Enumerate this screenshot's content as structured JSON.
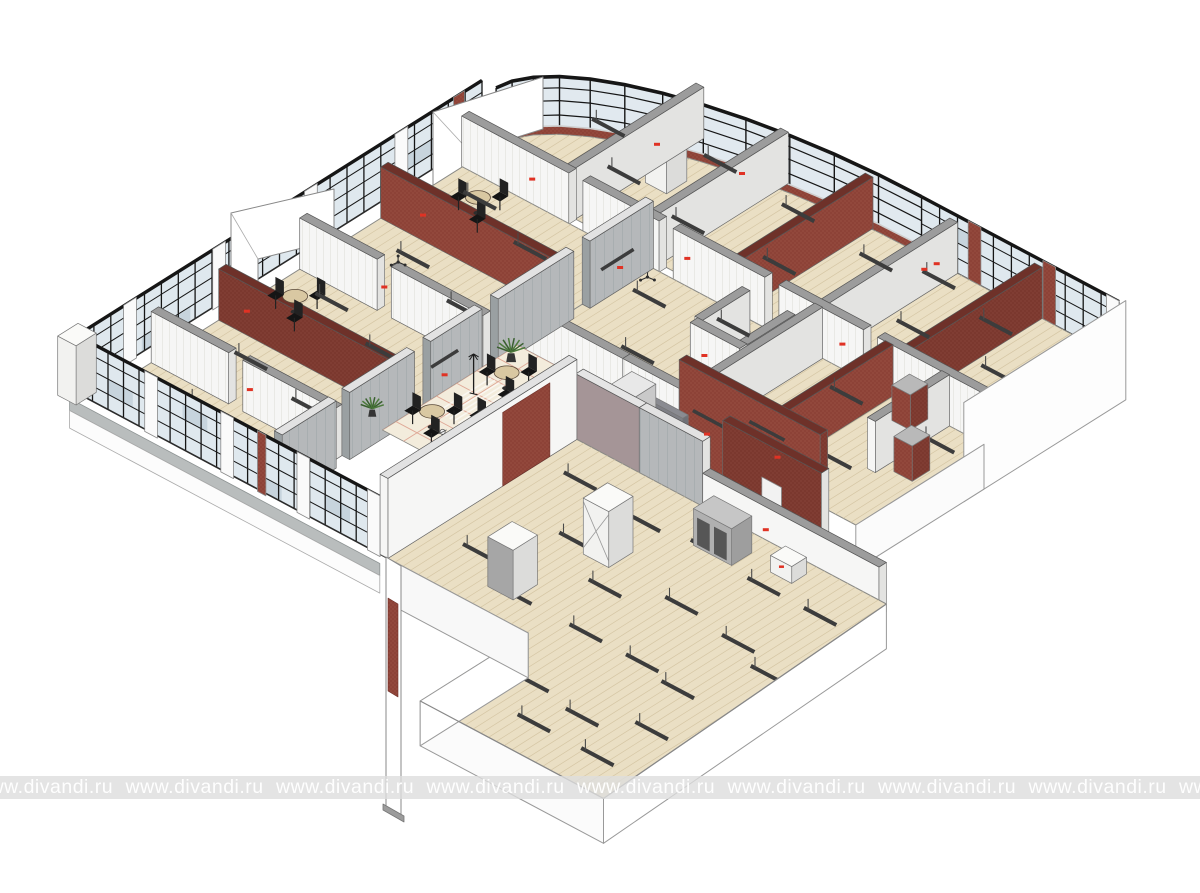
{
  "watermark": {
    "text": "www.divandi.ru",
    "repeat_count": 9,
    "band_color": "rgba(221,221,221,0.8)",
    "text_color": "rgba(255,255,255,0.95)"
  },
  "scene": {
    "type": "axonometric-cutaway-floor-plan",
    "description": "Isometric 3D cutaway of a building floor: glazed curtain-wall facades with black mullions, curved glass corner, brick partition walls, wood-plank floors, tiled lobby with cafe tables, chairs and plants, gray concrete walls, ceiling light bars, and a large open room at the bottom wing",
    "palette": {
      "background": "#ffffff",
      "floor_wood": "#eadfc4",
      "floor_plank_line": "#d5c6a4",
      "floor_tile": "#f3ecdc",
      "tile_line": "#dfa896",
      "bath_tile": "#f4f6f6",
      "bath_tile_line": "#ccd2d4",
      "wall_white": "#f6f6f5",
      "wall_white_side": "#e3e3e1",
      "wall_top_gray": "#9c9c9c",
      "wall_gray": "#b5b8ba",
      "wall_gray_dark": "#9aa0a2",
      "wall_mauve": "#a59597",
      "brick": "#8d4237",
      "brick_dark": "#7b382e",
      "brick_dot": "#a05648",
      "brick_top": "#6e3129",
      "glass": "#dfe8ee",
      "glass_dark": "#c7d4dd",
      "mullion": "#161616",
      "fixture_dark": "#3c3c3c",
      "marker_red": "#e03224",
      "plant_green": "#4c7a3c",
      "plant_green_dark": "#395f2f",
      "sofa_gray": "#8f9096",
      "table_top": "#d9c8a2",
      "plinth_gray": "#b9bdbd",
      "outline": "#666666"
    }
  }
}
